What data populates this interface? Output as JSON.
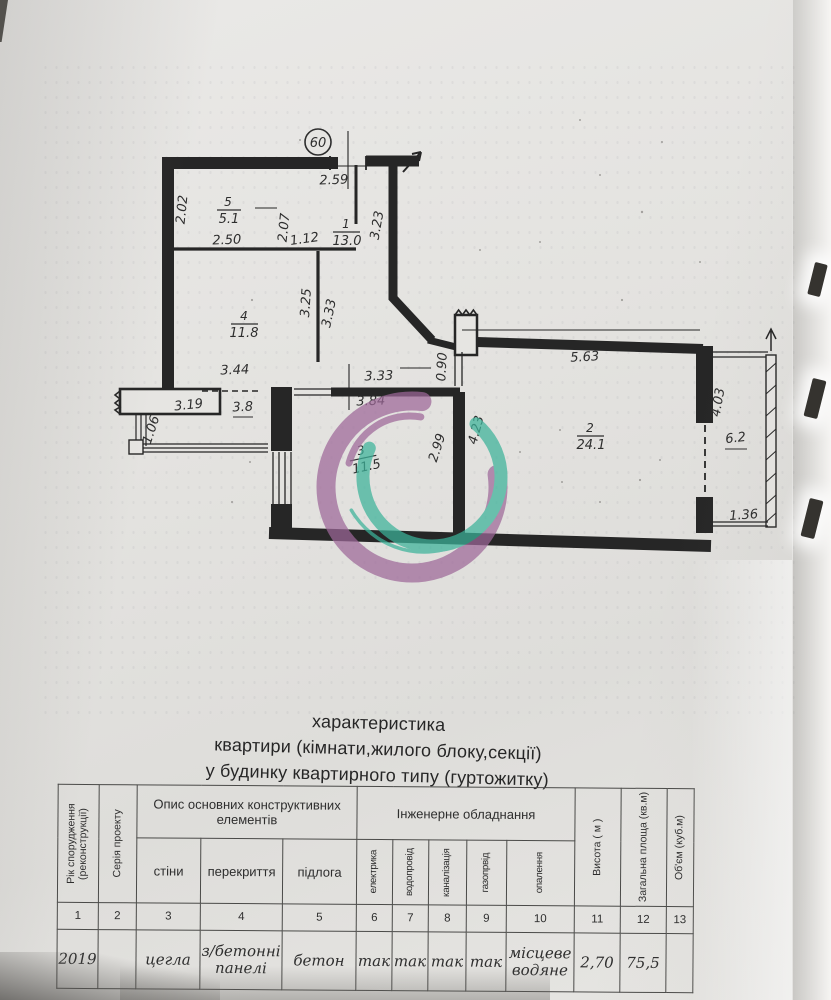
{
  "title": {
    "line1": "характеристика",
    "line2": "квартири (кімнати,жилого блоку,секції)",
    "line3": "у будинку квартирного типу (гуртожитку)"
  },
  "plan": {
    "apartment_circle": "60",
    "rooms": [
      {
        "num": "5",
        "area": "5.1"
      },
      {
        "num": "1",
        "area": "13.0"
      },
      {
        "num": "4",
        "area": "11.8"
      },
      {
        "num": "3",
        "area": "11.5"
      },
      {
        "num": "2",
        "area": "24.1"
      }
    ],
    "dims": [
      "2.59",
      "2.02",
      "2.50",
      "2.07",
      "1.12",
      "3.23",
      "3.25",
      "3.33",
      "3.44",
      "3.19",
      "1.06",
      "3.8",
      "3.33",
      "3.84",
      "0.90",
      "2.99",
      "4.23",
      "5.63",
      "4.03",
      "6.2",
      "1.36"
    ]
  },
  "table": {
    "desc_group": "Опис основних конструктивних елементів",
    "eng_group": "Інженерне обладнання",
    "columns": [
      {
        "num": "1",
        "label": "Рік спорудження (реконструкції)",
        "value": "2019"
      },
      {
        "num": "2",
        "label": "Серія проекту",
        "value": ""
      },
      {
        "num": "3",
        "label": "стіни",
        "value": "цегла"
      },
      {
        "num": "4",
        "label": "перекриття",
        "value": "з/бетонні панелі"
      },
      {
        "num": "5",
        "label": "підлога",
        "value": "бетон"
      },
      {
        "num": "6",
        "label": "електрика",
        "value": "так"
      },
      {
        "num": "7",
        "label": "водопровід",
        "value": "так"
      },
      {
        "num": "8",
        "label": "каналізація",
        "value": "так"
      },
      {
        "num": "9",
        "label": "газопрвід",
        "value": "так"
      },
      {
        "num": "10",
        "label": "опалення",
        "value": "місцеве водяне"
      },
      {
        "num": "11",
        "label": "Висота ( м )",
        "value": "2,70"
      },
      {
        "num": "12",
        "label": "Загальна площа (кв.м)",
        "value": "75,5"
      },
      {
        "num": "13",
        "label": "Об'єм (куб.м)",
        "value": ""
      }
    ]
  },
  "watermark": {
    "purple": "#9e6899",
    "teal": "#3cb39a"
  }
}
